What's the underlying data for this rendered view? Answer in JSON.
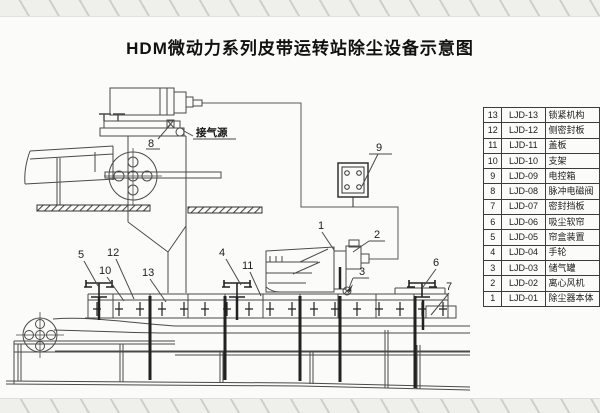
{
  "title": "HDM微动力系列皮带运转站除尘设备示意图",
  "air_source_label": "接气源",
  "callouts": {
    "n1": "1",
    "n2": "2",
    "n3": "3",
    "n4": "4",
    "n5": "5",
    "n6": "6",
    "n7": "7",
    "n8": "8",
    "n9": "9",
    "n10": "10",
    "n11": "11",
    "n12": "12",
    "n13": "13"
  },
  "parts_table": {
    "rows": [
      {
        "num": "13",
        "code": "LJD-13",
        "name": "锁紧机构"
      },
      {
        "num": "12",
        "code": "LJD-12",
        "name": "侧密封板"
      },
      {
        "num": "11",
        "code": "LJD-11",
        "name": "盖板"
      },
      {
        "num": "10",
        "code": "LJD-10",
        "name": "支架"
      },
      {
        "num": "9",
        "code": "LJD-09",
        "name": "电控箱"
      },
      {
        "num": "8",
        "code": "LJD-08",
        "name": "脉冲电磁阀"
      },
      {
        "num": "7",
        "code": "LJD-07",
        "name": "密封挡板"
      },
      {
        "num": "6",
        "code": "LJD-06",
        "name": "吸尘软帘"
      },
      {
        "num": "5",
        "code": "LJD-05",
        "name": "帘盒装置"
      },
      {
        "num": "4",
        "code": "LJD-04",
        "name": "手轮"
      },
      {
        "num": "3",
        "code": "LJD-03",
        "name": "储气罐"
      },
      {
        "num": "2",
        "code": "LJD-02",
        "name": "离心风机"
      },
      {
        "num": "1",
        "code": "LJD-01",
        "name": "除尘器本体"
      }
    ]
  },
  "colors": {
    "line": "#4a4a4a",
    "ink": "#222222",
    "paper": "#fbfbf9"
  }
}
